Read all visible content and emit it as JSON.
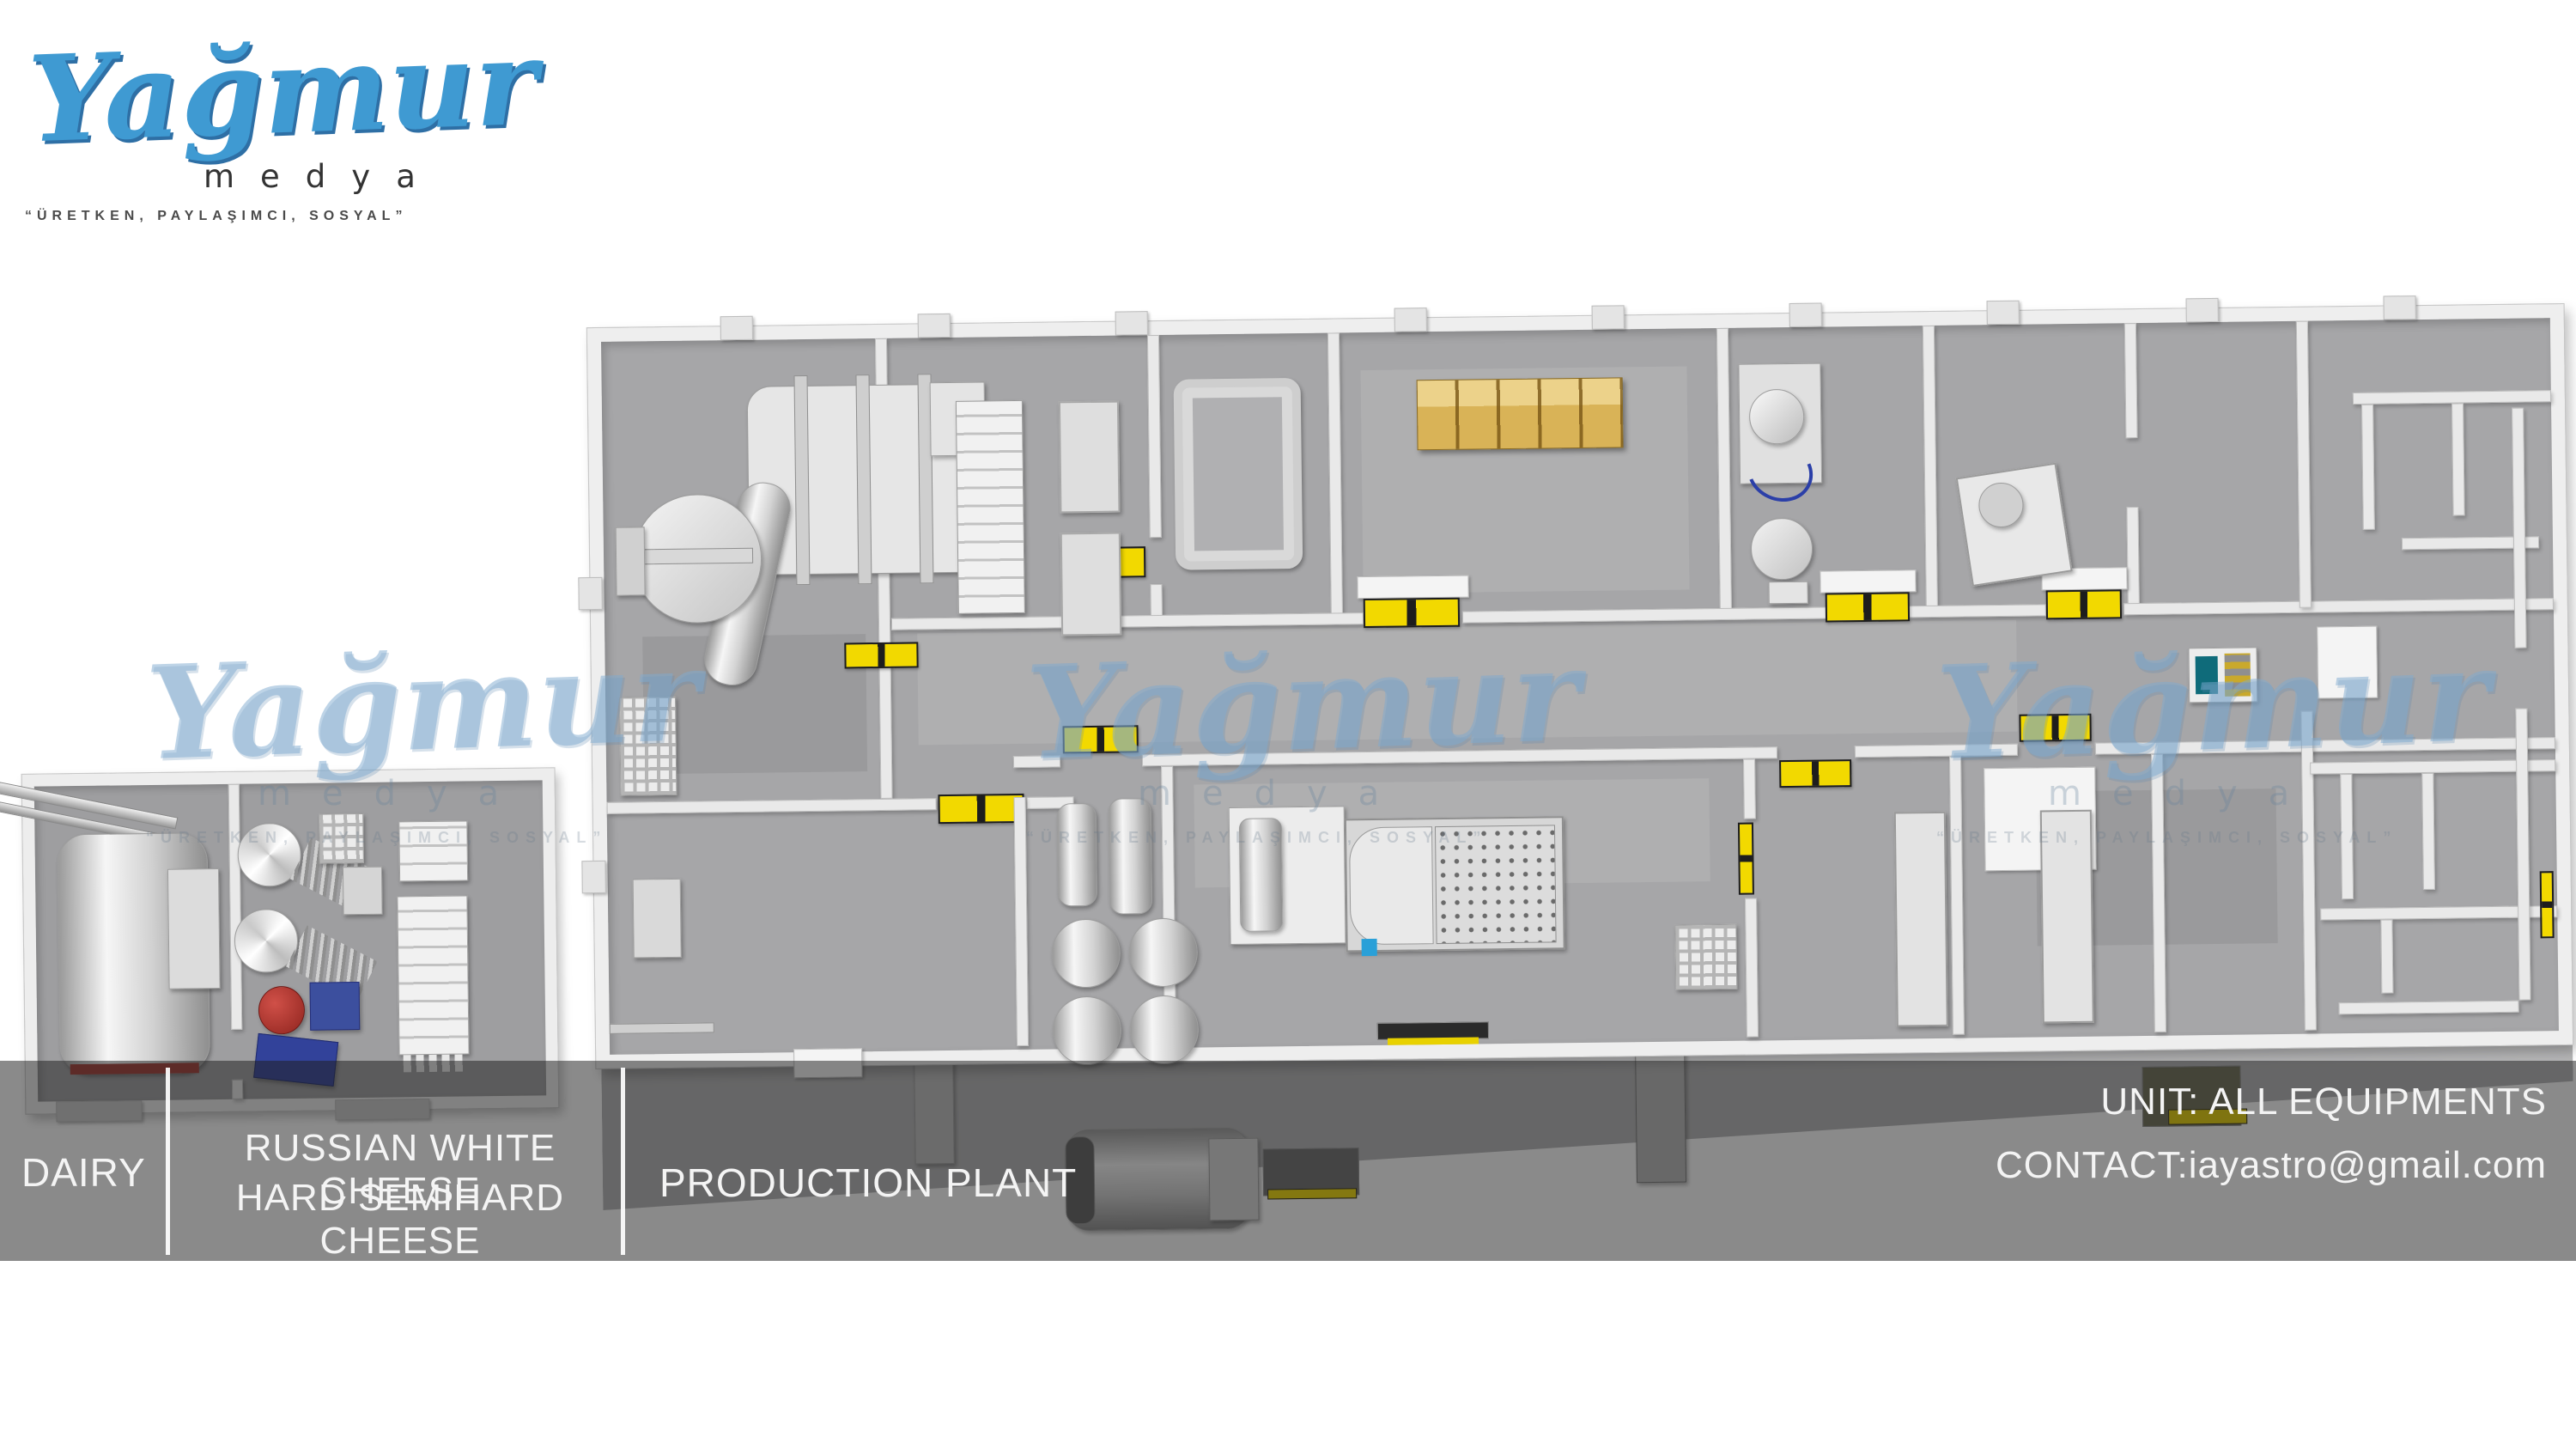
{
  "logo": {
    "brand": "Yağmur",
    "sub": "medya",
    "tagline": "“ÜRETKEN, PAYLAŞIMCI, SOSYAL”"
  },
  "watermark": {
    "brand": "Yağmur",
    "sub": "medya",
    "tagline": "“ÜRETKEN, PAYLAŞIMCI, SOSYAL”"
  },
  "footer": {
    "dairy": "DAIRY",
    "cheese_line1": "RUSSIAN WHITE CHEESE",
    "cheese_line2": "HARD SEMIHARD CHEESE",
    "production": "PRODUCTION PLANT",
    "unit": "UNIT: ALL EQUIPMENTS",
    "contact": "CONTACT:iayastro@gmail.com"
  },
  "colors": {
    "brand_blue": "#3f9ad2",
    "hazard_yellow": "#f2d900",
    "wood_shelf": "#d9b357",
    "tank_red": "#b23a32",
    "crate_blue": "#3c4f9e",
    "screen_teal": "#0f6b7a",
    "floor_gray": "#a6a6a8",
    "wall_white": "#e9e9e9",
    "overlay_bar": "rgba(30,30,30,0.52)"
  }
}
